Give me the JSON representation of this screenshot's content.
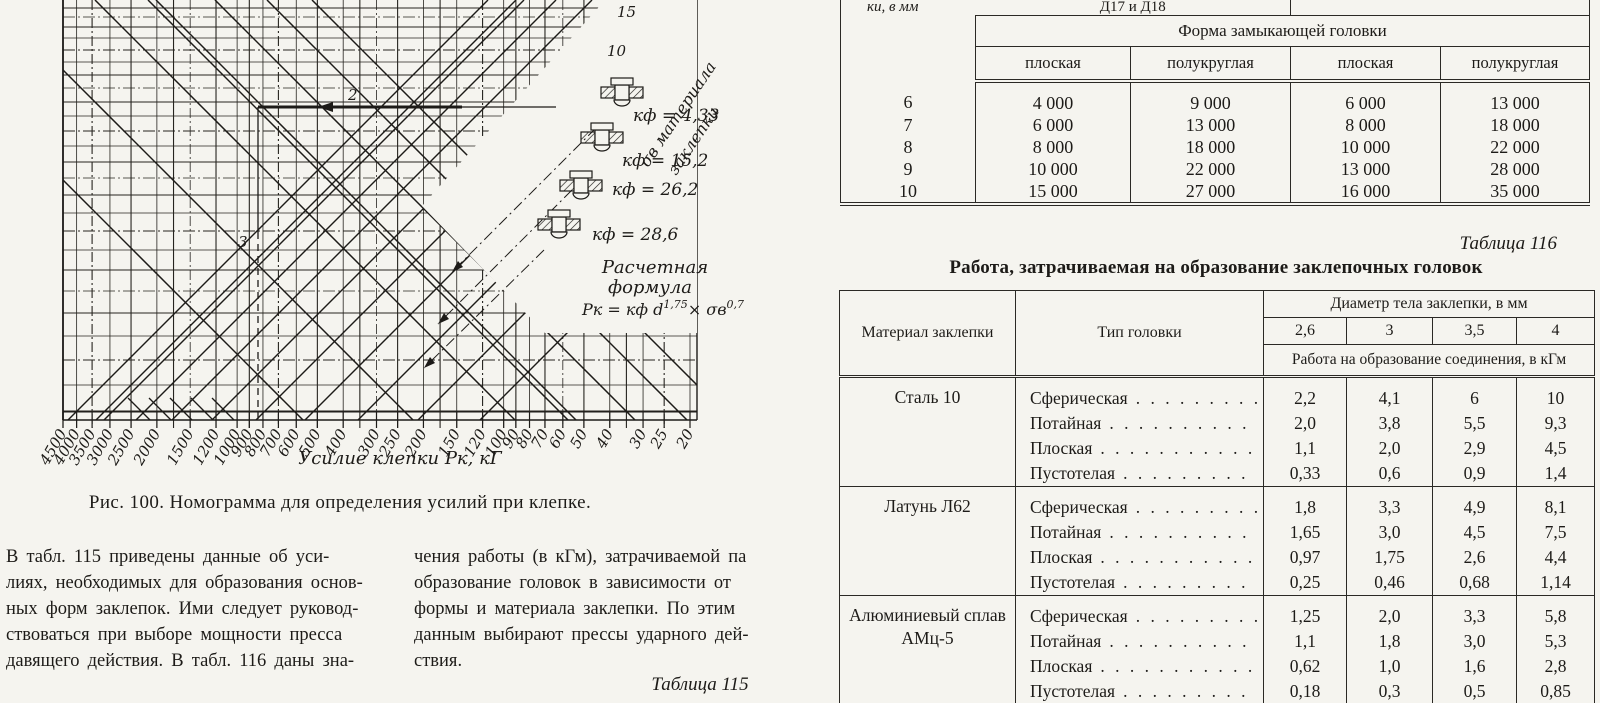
{
  "nomogram": {
    "caption": "Рис. 100. Номограмма для определения усилий при клепке.",
    "x_axis_title": "Усилие клепки  Рк, кГ",
    "x_ticks": [
      "4500",
      "4000",
      "3500",
      "3000",
      "2500",
      "2000",
      "1500",
      "1200",
      "1000",
      "900",
      "800",
      "700",
      "600",
      "500",
      "400",
      "300",
      "250",
      "200",
      "150",
      "120",
      "100",
      "90",
      "80",
      "70",
      "60",
      "50",
      "40",
      "30",
      "25",
      "20"
    ],
    "diag_ticks": [
      "15",
      "10"
    ],
    "diag_axis_label_line1": "σв материала",
    "diag_axis_label_line2": "заклепки",
    "legend_kf": [
      "кф = 4,33",
      "кф = 15,2",
      "кф = 26,2",
      "кф = 28,6"
    ],
    "formula_title_line1": "Расчетная",
    "formula_title_line2": "формула",
    "formula": {
      "base1": "Рк = кф d",
      "exp1": "1,75",
      "base2": "× σв",
      "exp2": "0,7"
    },
    "trace_labels": {
      "horizontal": "2",
      "vertical": "3"
    }
  },
  "intro_text": {
    "left_col": "В табл. 115 приведены данные об уси-\nлиях, необходимых для образования основ-\nных форм заклепок. Ими следует руковод-\nствоваться при выборе мощности пресса\nдавящего действия. В табл. 116 даны зна-",
    "right_col": "чения работы (в кГм), затрачиваемой па\nобразование головок в зависимости от\nформы и материала заклепки. По этим\nданным выбирают прессы ударного дей-\nствия."
  },
  "table115_label": "Таблица 115",
  "rivet_force_table": {
    "col1_header_visible": "ки, в мм",
    "alloy_group_header": "Д17 и Д18",
    "form_header": "Форма замыкающей головки",
    "sub_headers": [
      "плоская",
      "полукруглая",
      "плоская",
      "полукруглая"
    ],
    "rows": [
      {
        "d": "6",
        "values": [
          "4 000",
          "9 000",
          "6 000",
          "13 000"
        ]
      },
      {
        "d": "7",
        "values": [
          "6 000",
          "13 000",
          "8 000",
          "18 000"
        ]
      },
      {
        "d": "8",
        "values": [
          "8 000",
          "18 000",
          "10 000",
          "22 000"
        ]
      },
      {
        "d": "9",
        "values": [
          "10 000",
          "22 000",
          "13 000",
          "28 000"
        ]
      },
      {
        "d": "10",
        "values": [
          "15 000",
          "27 000",
          "16 000",
          "35 000"
        ]
      }
    ]
  },
  "work_table": {
    "label": "Таблица 116",
    "title": "Работа, затрачиваемая на образование заклепочных головок",
    "material_header": "Материал заклепки",
    "type_header": "Тип головки",
    "diameter_header": "Диаметр тела заклепки, в мм",
    "diameters": [
      "2,6",
      "3",
      "3,5",
      "4"
    ],
    "work_header": "Работа на образование соединения, в кГм",
    "groups": [
      {
        "material": "Сталь 10",
        "rows": [
          {
            "type": "Сферическая",
            "values": [
              "2,2",
              "4,1",
              "6",
              "10"
            ]
          },
          {
            "type": "Потайная",
            "values": [
              "2,0",
              "3,8",
              "5,5",
              "9,3"
            ]
          },
          {
            "type": "Плоская",
            "values": [
              "1,1",
              "2,0",
              "2,9",
              "4,5"
            ]
          },
          {
            "type": "Пустотелая",
            "values": [
              "0,33",
              "0,6",
              "0,9",
              "1,4"
            ]
          }
        ]
      },
      {
        "material": "Латунь Л62",
        "rows": [
          {
            "type": "Сферическая",
            "values": [
              "1,8",
              "3,3",
              "4,9",
              "8,1"
            ]
          },
          {
            "type": "Потайная",
            "values": [
              "1,65",
              "3,0",
              "4,5",
              "7,5"
            ]
          },
          {
            "type": "Плоская",
            "values": [
              "0,97",
              "1,75",
              "2,6",
              "4,4"
            ]
          },
          {
            "type": "Пустотелая",
            "values": [
              "0,25",
              "0,46",
              "0,68",
              "1,14"
            ]
          }
        ]
      },
      {
        "material": "Алюминиевый сплав АМц-5",
        "rows": [
          {
            "type": "Сферическая",
            "values": [
              "1,25",
              "2,0",
              "3,3",
              "5,8"
            ]
          },
          {
            "type": "Потайная",
            "values": [
              "1,1",
              "1,8",
              "3,0",
              "5,3"
            ]
          },
          {
            "type": "Плоская",
            "values": [
              "0,62",
              "1,0",
              "1,6",
              "2,8"
            ]
          },
          {
            "type": "Пустотелая",
            "values": [
              "0,18",
              "0,3",
              "0,5",
              "0,85"
            ]
          }
        ]
      }
    ]
  }
}
